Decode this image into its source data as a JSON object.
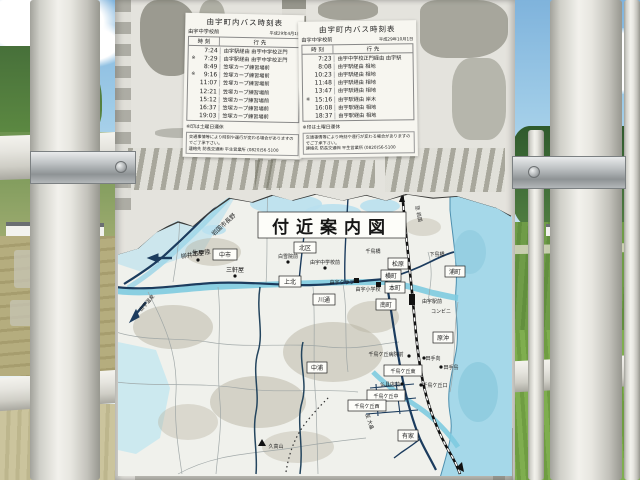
{
  "scene_title": "由宇町内バス時刻表と付近案内図の掲示板",
  "colors": {
    "water": "#a5d8e9",
    "road": "#1c3c5e",
    "railway": "#111111",
    "board": "#e4e3dd"
  },
  "timetables": [
    {
      "title": "由宇町内バス時刻表",
      "stop": "由宇中学校前",
      "date": "平成29年4月1日",
      "col_time": "時 刻",
      "col_dest": "行 先",
      "rows": [
        {
          "mark": "",
          "time": "7:24",
          "dest": "由宇駅経由 由宇中学校正門"
        },
        {
          "mark": "※",
          "time": "7:29",
          "dest": "由宇駅経由 由宇中学校正門"
        },
        {
          "mark": "",
          "time": "8:49",
          "dest": "笠塚カープ練習場前"
        },
        {
          "mark": "※",
          "time": "9:16",
          "dest": "笠塚カープ練習場前"
        },
        {
          "mark": "",
          "time": "11:07",
          "dest": "笠塚カープ練習場前"
        },
        {
          "mark": "",
          "time": "12:21",
          "dest": "笠塚カープ練習場前"
        },
        {
          "mark": "",
          "time": "15:12",
          "dest": "笠塚カープ練習場前"
        },
        {
          "mark": "",
          "time": "16:37",
          "dest": "笠塚カープ練習場前"
        },
        {
          "mark": "",
          "time": "19:03",
          "dest": "笠塚カープ練習場前"
        }
      ],
      "note": "※印は土曜日運休",
      "notice": "交通事情等により時刻や運行が変わる場合がありますのでご了承下さい。",
      "contact": "連絡先 防長交通㈱ 平生営業所 (0820)56-5100"
    },
    {
      "title": "由宇町内バス時刻表",
      "stop": "由宇中学校前",
      "date": "平成29年10月1日",
      "col_time": "時 刻",
      "col_dest": "行 先",
      "rows": [
        {
          "mark": "",
          "time": "7:23",
          "dest": "由宇中学校正門経由 由宇駅"
        },
        {
          "mark": "",
          "time": "8:08",
          "dest": "由宇駅経由 相地"
        },
        {
          "mark": "",
          "time": "10:23",
          "dest": "由宇駅経由 相地"
        },
        {
          "mark": "",
          "time": "11:48",
          "dest": "由宇駅経由 相地"
        },
        {
          "mark": "",
          "time": "13:47",
          "dest": "由宇駅経由 相地"
        },
        {
          "mark": "※",
          "time": "15:16",
          "dest": "由宇駅経由 岸木"
        },
        {
          "mark": "",
          "time": "16:08",
          "dest": "由宇駅経由 相地"
        },
        {
          "mark": "",
          "time": "18:37",
          "dest": "由宇駅経由 相地"
        }
      ],
      "note": "※印は土曜日運休",
      "notice": "交通事情等により時刻や運行が変わる場合がありますのでご了承下さい。",
      "contact": "連絡先 防長交通㈱ 平生営業所 (0820)56-5100"
    }
  ],
  "map": {
    "title": "付近案内図",
    "labels": [
      {
        "text": "岩国市長野",
        "type": "direction"
      },
      {
        "text": "柳井市伊陸",
        "type": "direction"
      },
      {
        "text": "生屋",
        "type": "bus-stop"
      },
      {
        "text": "中市",
        "type": "district"
      },
      {
        "text": "三軒屋",
        "type": "bus-stop"
      },
      {
        "text": "北区",
        "type": "district"
      },
      {
        "text": "白雪院前",
        "type": "bus-stop"
      },
      {
        "text": "由宇中学校前",
        "type": "bus-stop"
      },
      {
        "text": "上北",
        "type": "district"
      },
      {
        "text": "川通",
        "type": "district"
      },
      {
        "text": "千鳥橋",
        "type": "bridge"
      },
      {
        "text": "由宇クラブ",
        "type": "building"
      },
      {
        "text": "由宇小学校",
        "type": "building"
      },
      {
        "text": "松原",
        "type": "district"
      },
      {
        "text": "横町",
        "type": "district"
      },
      {
        "text": "本町",
        "type": "district"
      },
      {
        "text": "南町",
        "type": "district"
      },
      {
        "text": "浦町",
        "type": "district"
      },
      {
        "text": "下島橋",
        "type": "bridge"
      },
      {
        "text": "至 岩国",
        "type": "direction"
      },
      {
        "text": "由宇駅前",
        "type": "station"
      },
      {
        "text": "コンビニ",
        "type": "building"
      },
      {
        "text": "原沖",
        "type": "district"
      },
      {
        "text": "中浦",
        "type": "district"
      },
      {
        "text": "千鳥ケ丘病院前",
        "type": "bus-stop"
      },
      {
        "text": "田手向",
        "type": "bus-stop"
      },
      {
        "text": "田手島",
        "type": "bus-stop"
      },
      {
        "text": "千鳥ケ丘東",
        "type": "district"
      },
      {
        "text": "仏具店前",
        "type": "bus-stop"
      },
      {
        "text": "千鳥ケ丘口",
        "type": "bus-stop"
      },
      {
        "text": "千鳥ケ丘中",
        "type": "district"
      },
      {
        "text": "千鳥ケ丘西",
        "type": "district"
      },
      {
        "text": "有家",
        "type": "district"
      },
      {
        "text": "久高山",
        "type": "mountain"
      },
      {
        "text": "至 大畠",
        "type": "direction"
      },
      {
        "text": "由宇温泉",
        "type": "direction"
      }
    ]
  }
}
